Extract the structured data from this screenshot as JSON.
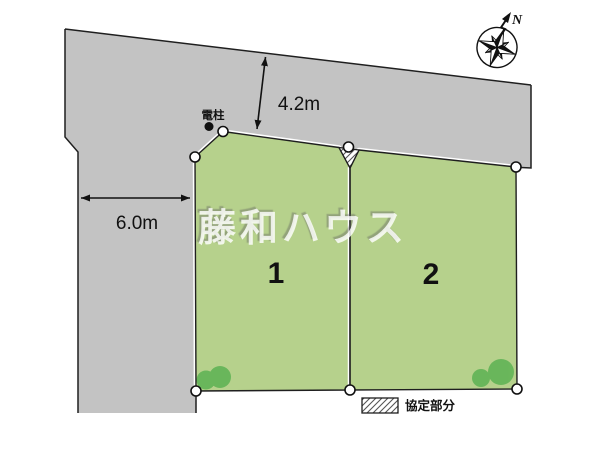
{
  "colors": {
    "background": "#ffffff",
    "road": "#c3c3c3",
    "lot_fill": "#b6d18c",
    "shrub": "#57b04f",
    "line": "#1f1f1f"
  },
  "compass": {
    "north_label": "N"
  },
  "dimensions": [
    {
      "label": "4.2m"
    },
    {
      "label": "6.0m"
    }
  ],
  "annotations": {
    "utility_pole": "電柱"
  },
  "lots": [
    {
      "number": "1"
    },
    {
      "number": "2"
    }
  ],
  "legend": {
    "hatch_label": "協定部分"
  },
  "watermark": {
    "text": "藤和ハウス"
  }
}
